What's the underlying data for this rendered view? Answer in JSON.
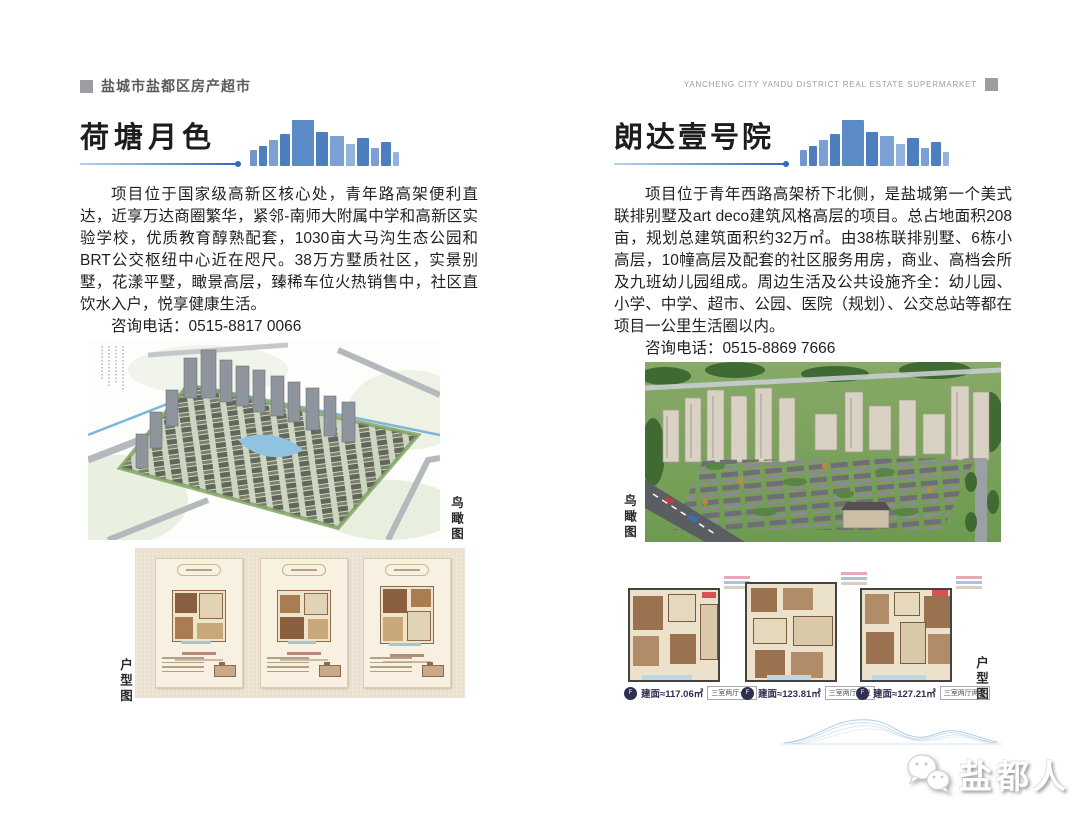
{
  "header": {
    "title_cn": "盐城市盐都区房产超市",
    "title_en": "YANCHENG CITY YANDU DISTRICT REAL ESTATE SUPERMARKET"
  },
  "projects": [
    {
      "name": "荷塘月色",
      "description": "项目位于国家级高新区核心处，青年路高架便利直达，近享万达商圈繁华，紧邻-南师大附属中学和高新区实验学校，优质教育醇熟配套，1030亩大马沟生态公园和BRT公交枢纽中心近在咫尺。38万方墅质社区，实景别墅，花漾平墅，瞰景高层，臻稀车位火热销售中，社区直饮水入户，悦享健康生活。",
      "phone_line": "咨询电话：0515-8817 0066",
      "aerial_label": "鸟瞰图",
      "floorplan_label": "户型图"
    },
    {
      "name": "朗达壹号院",
      "description": "项目位于青年西路高架桥下北侧，是盐城第一个美式联排别墅及art deco建筑风格高层的项目。总占地面积208亩，规划总建筑面积约32万㎡。由38栋联排别墅、6栋小高层，10幢高层及配套的社区服务用房，商业、高档会所及九班幼儿园组成。周边生活及公共设施齐全：幼儿园、小学、中学、超市、公园、医院（规划）、公交总站等都在项目一公里生活圈以内。",
      "phone_line": "咨询电话：0515-8869 7666",
      "aerial_label": "鸟瞰图",
      "floorplan_label": "户型图",
      "floorplans": [
        {
          "area": "建面≈117.06㎡",
          "layout": "三室两厅一卫"
        },
        {
          "area": "建面≈123.81㎡",
          "layout": "三室两厅两卫"
        },
        {
          "area": "建面≈127.21㎡",
          "layout": "三室两厅两卫"
        }
      ]
    }
  ],
  "footer": {
    "brand": "盐都人"
  },
  "colors": {
    "accent_blue": "#2f6db5",
    "skyline_blue": "#5b87c5",
    "header_gray": "#9b9da0"
  }
}
